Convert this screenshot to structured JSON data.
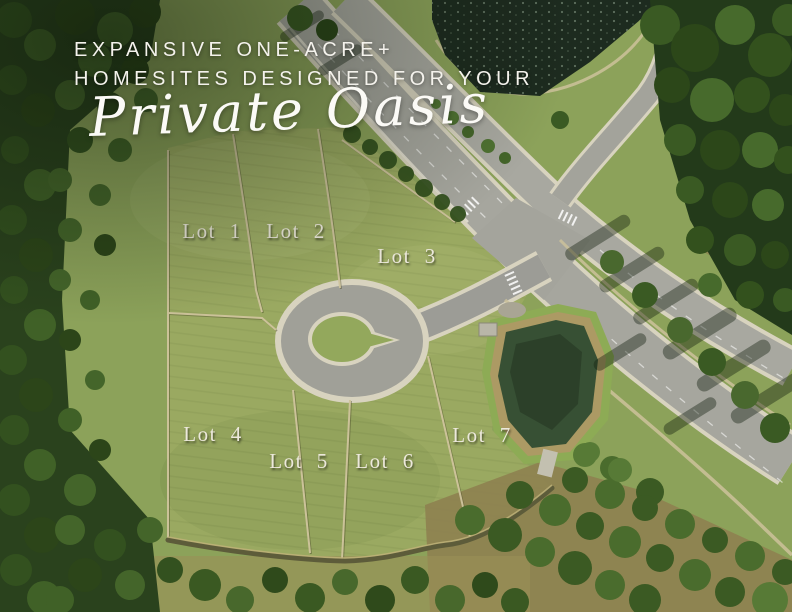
{
  "hero": {
    "headline_line1": "EXPANSIVE ONE-ACRE+",
    "headline_line2": "HOMESITES DESIGNED FOR YOUR",
    "script_text": "Private Oasis"
  },
  "lots": [
    {
      "label": "Lot 1"
    },
    {
      "label": "Lot 2"
    },
    {
      "label": "Lot 3"
    },
    {
      "label": "Lot 4"
    },
    {
      "label": "Lot 5"
    },
    {
      "label": "Lot 6"
    },
    {
      "label": "Lot 7"
    }
  ],
  "colors": {
    "headline_text": "#f4f2ec",
    "lot_label_text": "#ece8db",
    "grass_base": "#8ca25a",
    "grass_field": "#9aa961",
    "forest_dark": "#2a421d",
    "tree_canopy": "#44652a",
    "asphalt": "#a6a69e",
    "curb_concrete": "#d8d3bf",
    "lake_water": "#1d2b1f",
    "pond_water": "#375034",
    "pond_fringe": "#ac9a64",
    "dirt_ground": "#8e8150",
    "trail_sand": "#cdc29b"
  }
}
